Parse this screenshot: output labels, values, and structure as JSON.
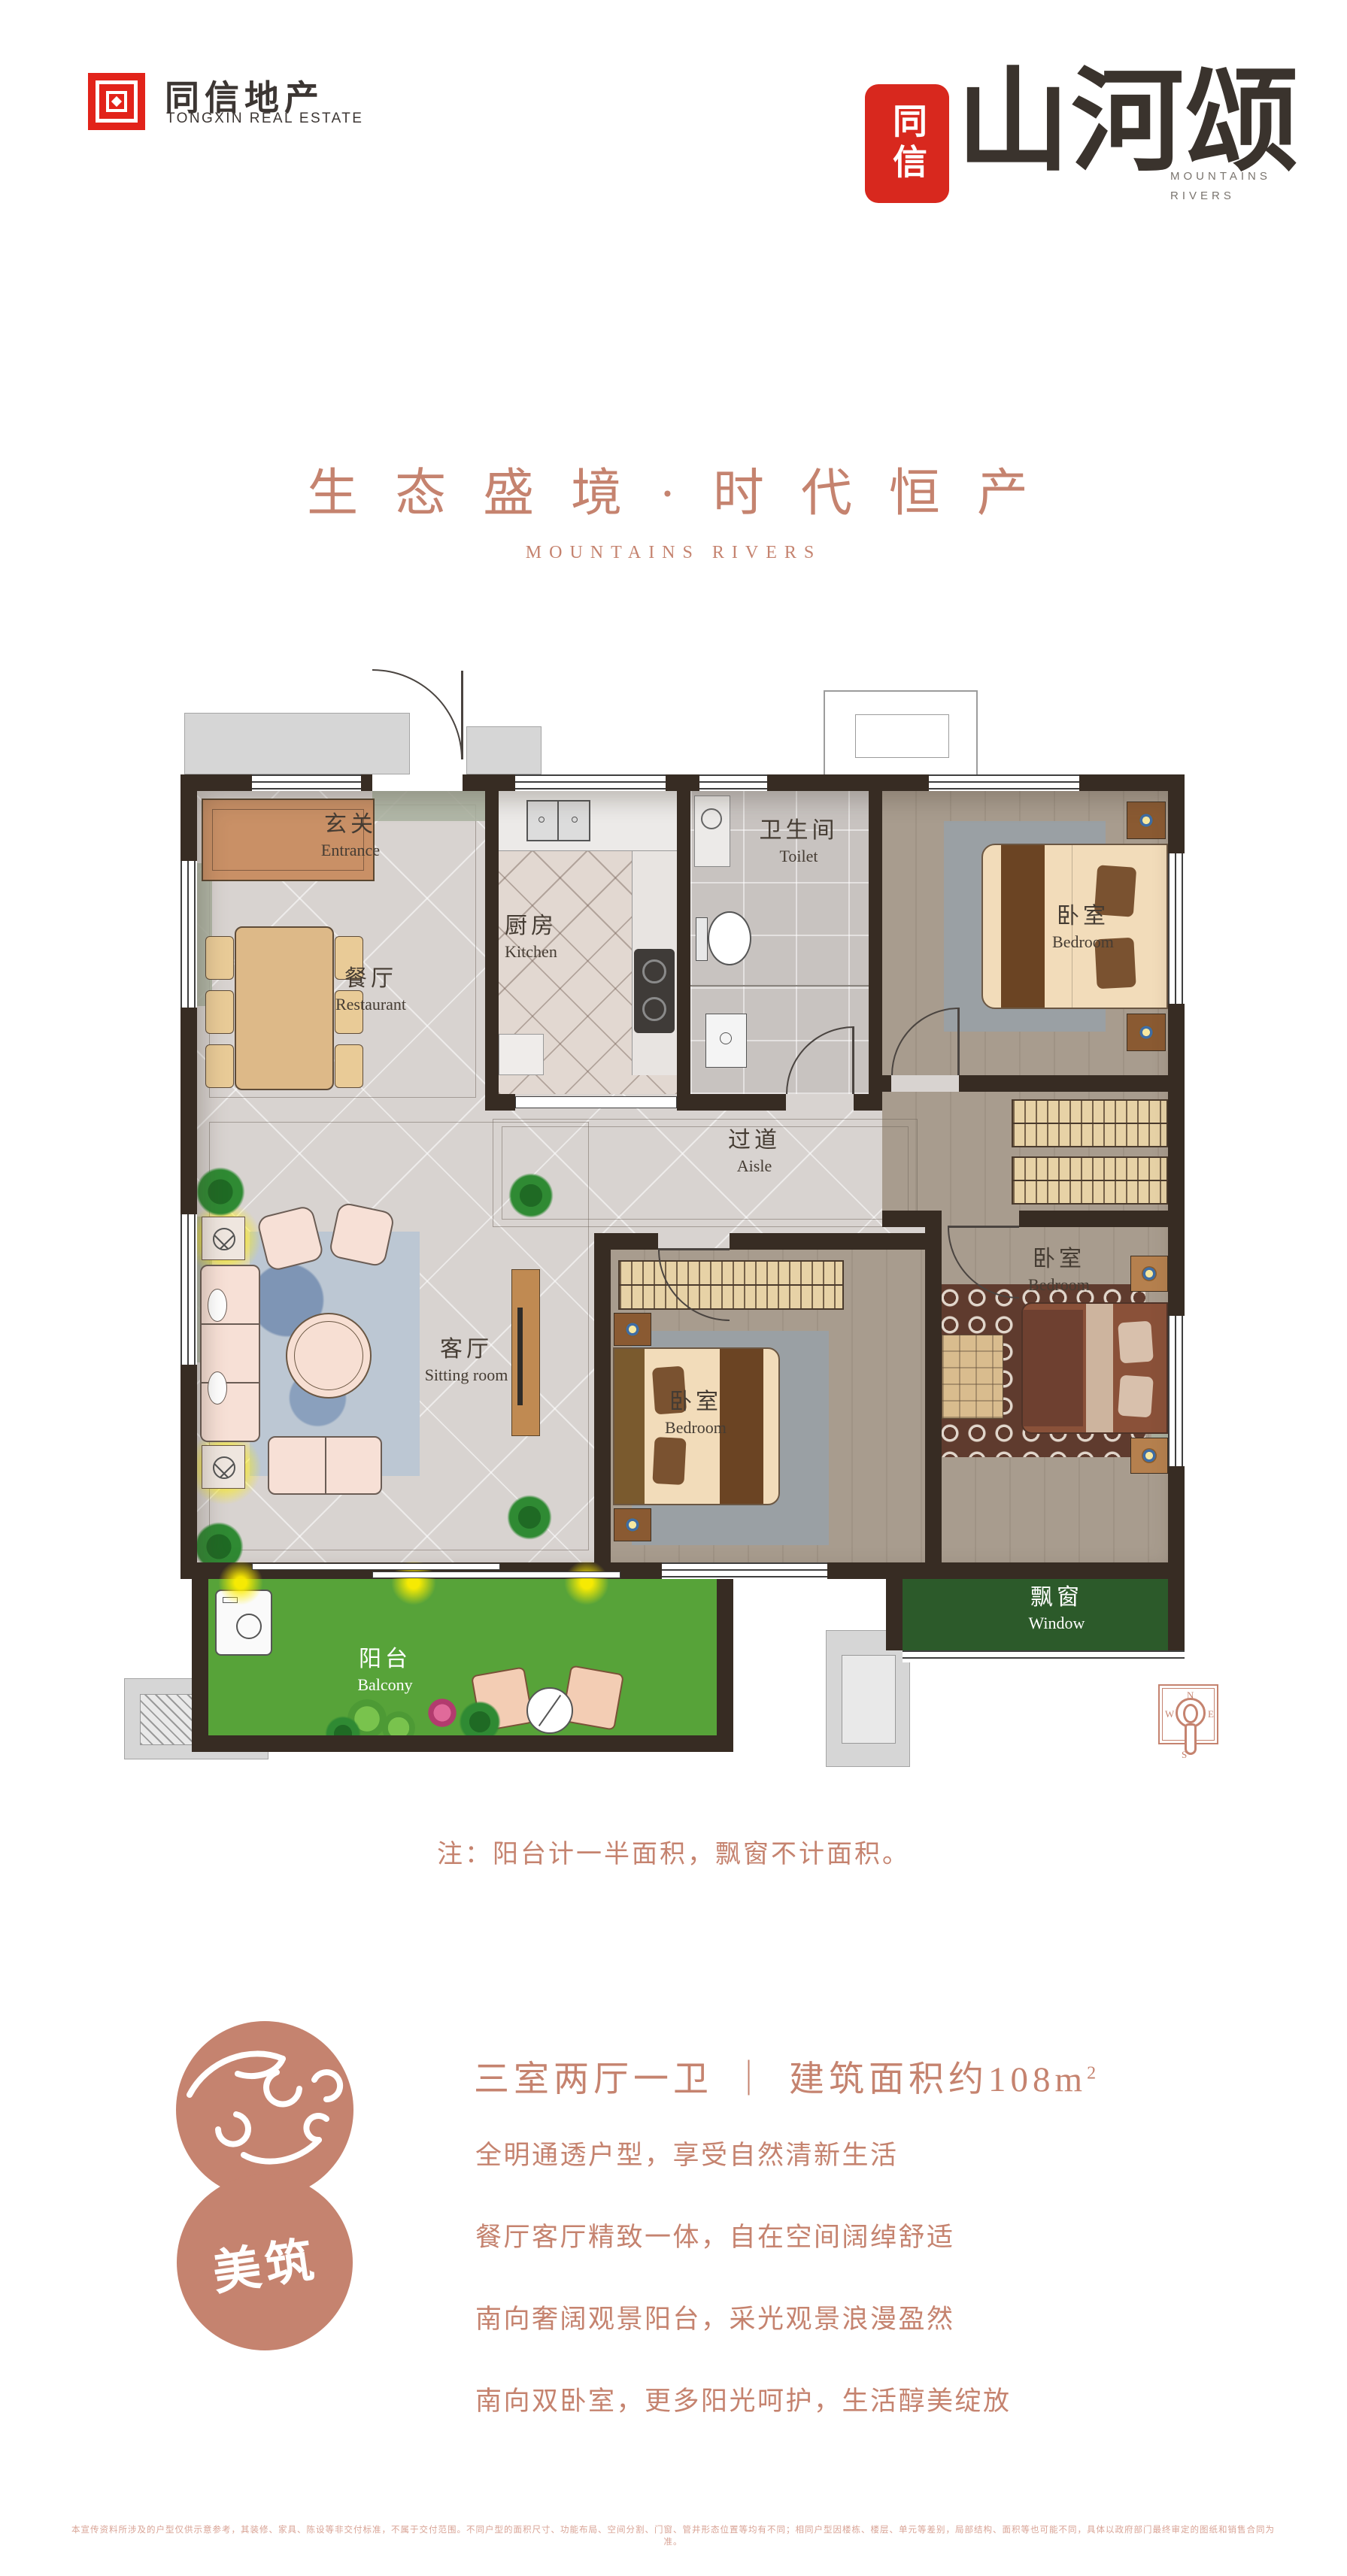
{
  "brand": {
    "logo_text_cn": "同信地产",
    "logo_text_en": "TONGXIN REAL ESTATE"
  },
  "art_logo": {
    "seal": "同信",
    "name": "山河颂",
    "sub_line1": "MOUNTAINS",
    "sub_line2": "RIVERS"
  },
  "hero": {
    "title": "生 态 盛 境 · 时 代 恒 产",
    "subtitle": "MOUNTAINS RIVERS"
  },
  "plan": {
    "note": "注：阳台计一半面积，飘窗不计面积。",
    "rooms": {
      "entrance": {
        "cn": "玄关",
        "en": "Entrance"
      },
      "restaurant": {
        "cn": "餐厅",
        "en": "Restaurant"
      },
      "kitchen": {
        "cn": "厨房",
        "en": "Kitchen"
      },
      "toilet": {
        "cn": "卫生间",
        "en": "Toilet"
      },
      "bedroom1": {
        "cn": "卧室",
        "en": "Bedroom"
      },
      "aisle": {
        "cn": "过道",
        "en": "Aisle"
      },
      "sitting": {
        "cn": "客厅",
        "en": "Sitting room"
      },
      "bedroom2": {
        "cn": "卧室",
        "en": "Bedroom"
      },
      "bedroom3": {
        "cn": "卧室",
        "en": "Bedroom"
      },
      "balcony": {
        "cn": "阳台",
        "en": "Balcony"
      },
      "window": {
        "cn": "飘窗",
        "en": "Window"
      }
    },
    "compass": {
      "n": "N",
      "e": "E",
      "s": "S",
      "w": "W"
    }
  },
  "details": {
    "badge": "美筑",
    "headline": {
      "left": "三室两厅一卫",
      "divider": "｜",
      "right": "建筑面积约108m",
      "sup": "2"
    },
    "features": [
      "全明通透户型，享受自然清新生活",
      "餐厅客厅精致一体，自在空间阔绰舒适",
      "南向奢阔观景阳台，采光观景浪漫盈然",
      "南向双卧室，更多阳光呵护，生活醇美绽放"
    ]
  },
  "disclaimer": "本宣传资料所涉及的户型仅供示意参考，其装修、家具、陈设等非交付标准，不属于交付范围。不同户型的面积尺寸、功能布局、空间分割、门窗、管井形态位置等均有不同；相同户型因楼栋、楼层、单元等差别，局部结构、面积等也可能不同，具体以政府部门最终审定的图纸和销售合同为准。",
  "colors": {
    "accent": "#c5836f",
    "logo_red": "#e2231a",
    "wall": "#372c23",
    "grass": "#57a339",
    "window_green": "#2c5a2a"
  }
}
